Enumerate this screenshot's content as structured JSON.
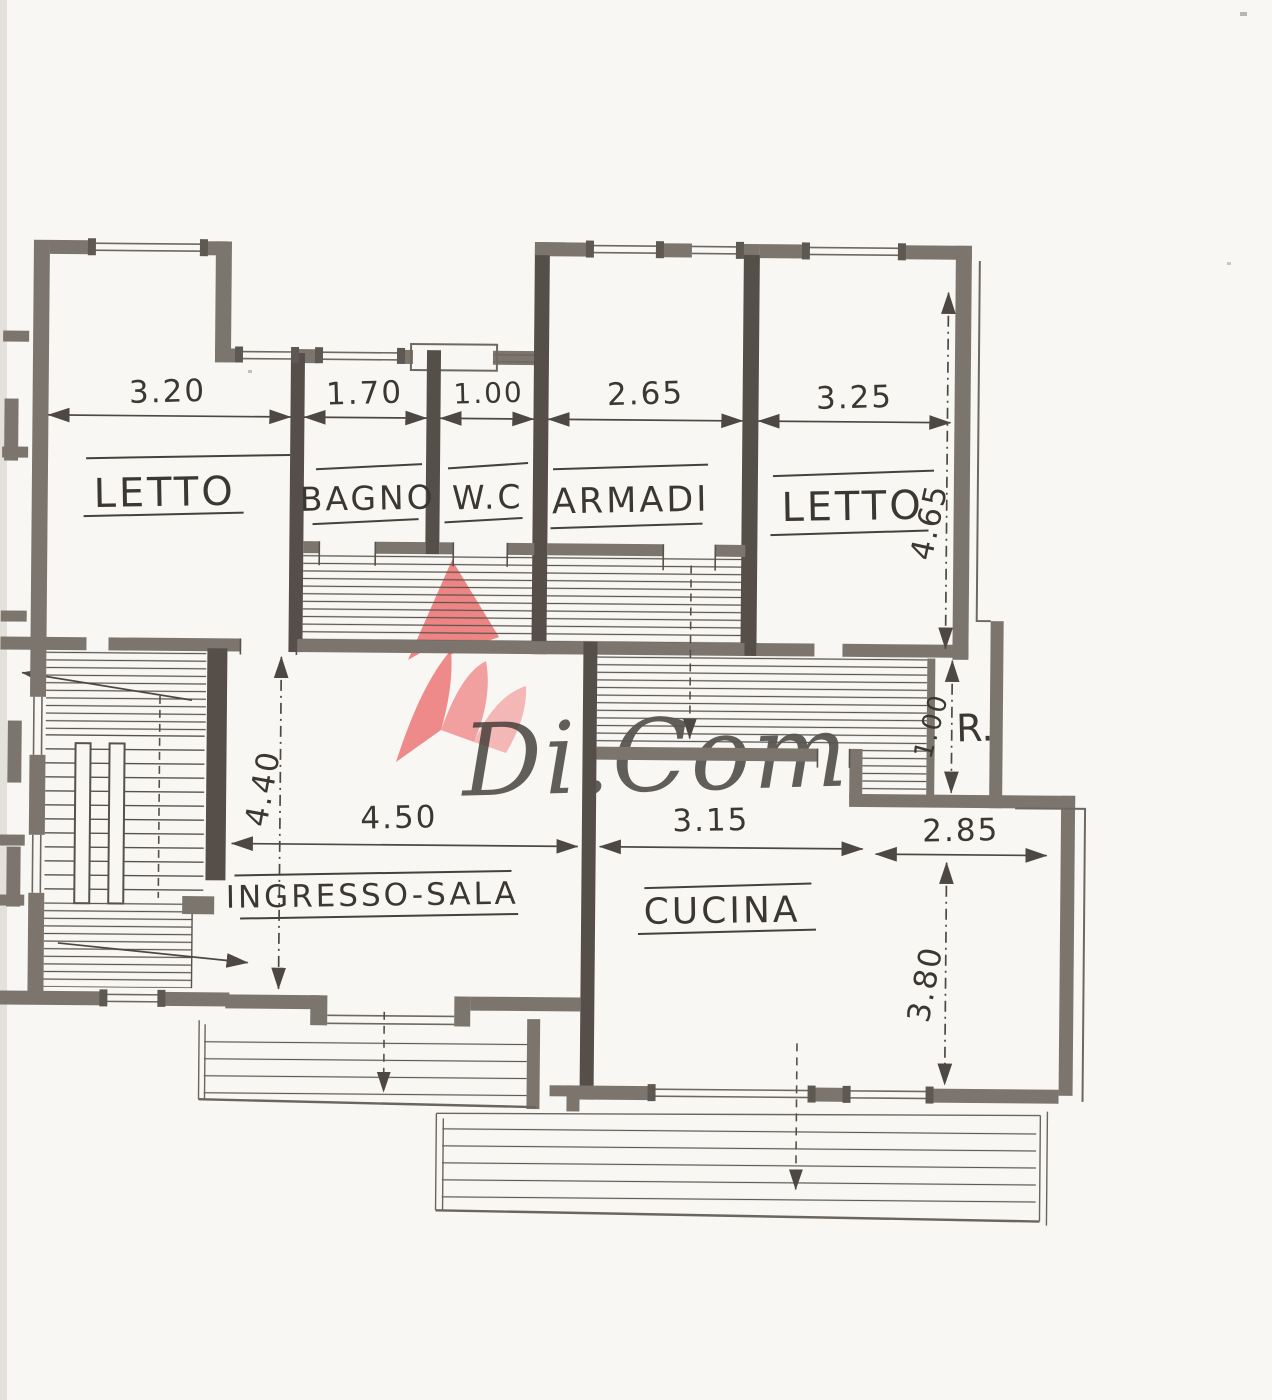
{
  "watermark": {
    "text": "Di.Com"
  },
  "rooms": {
    "letto_left": "LETTO",
    "bagno": "BAGNO",
    "wc": "W.C",
    "armadi": "ARMADI",
    "letto_right": "LETTO",
    "ingresso": "INGRESSO-SALA",
    "cucina": "CUCINA",
    "ripostiglio": "R."
  },
  "dimensions": {
    "letto_left_width": "3.20",
    "bagno_width": "1.70",
    "wc_width": "1.00",
    "armadi_width": "2.65",
    "letto_right_width": "3.25",
    "letto_right_height": "4.65",
    "hall_height": "4.40",
    "hall_width": "4.50",
    "kitchen_width": "3.15",
    "kitchen_east_width": "2.85",
    "kitchen_height": "3.80",
    "closet_height": "1.00"
  },
  "colors": {
    "paper": "#f9f7f3",
    "wall_gray": "#7b756e",
    "wall_dark": "#564f49",
    "ink": "#3b3733",
    "accent_red": "#ec6b6b",
    "watermark_gray": "#8f8d8b"
  }
}
